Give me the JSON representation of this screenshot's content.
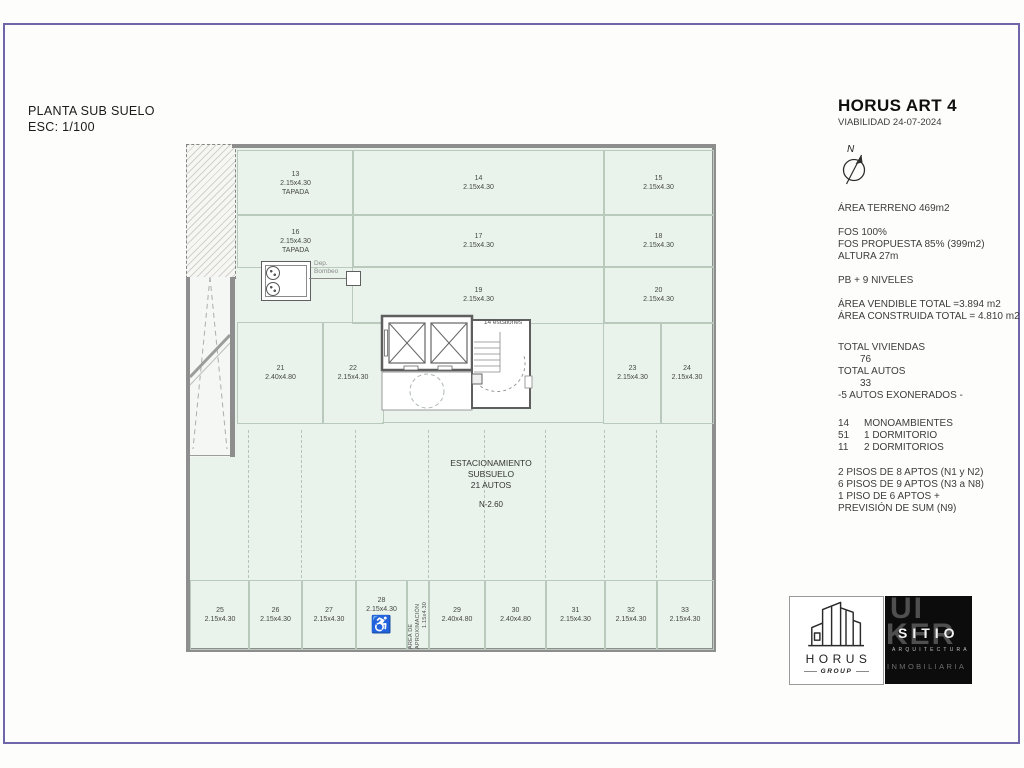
{
  "title_block": {
    "line1": "PLANTA SUB SUELO",
    "line2": "ESC: 1/100"
  },
  "info_panel": {
    "title": "HORUS ART 4",
    "subtitle": "VIABILIDAD 24-07-2024",
    "north_label": "N",
    "area_terreno": "ÁREA TERRENO 469m2",
    "fos": [
      "FOS 100%",
      "FOS PROPUESTA 85% (399m2)",
      "ALTURA 27m"
    ],
    "niveles": "PB + 9 NIVELES",
    "areas": [
      "ÁREA VENDIBLE TOTAL =3.894 m2",
      "ÁREA CONSTRUIDA TOTAL = 4.810 m2"
    ],
    "totals": {
      "l1": "TOTAL VIVIENDAS",
      "v1": "76",
      "l2": "TOTAL AUTOS",
      "v2": "33",
      "l3": "-5 AUTOS EXONERADOS -"
    },
    "units": [
      {
        "n": "14",
        "label": "MONOAMBIENTES"
      },
      {
        "n": "51",
        "label": "1 DORMITORIO"
      },
      {
        "n": "11",
        "label": "2 DORMITORIOS"
      }
    ],
    "pisos": [
      "2 PISOS DE 8 APTOS (N1 y N2)",
      "6 PISOS DE 9 APTOS (N3 a N8)",
      "1 PISO DE 6 APTOS +",
      "PREVISIÓN DE SUM (N9)"
    ]
  },
  "plan": {
    "center_label": [
      "ESTACIONAMIENTO",
      "SUBSUELO",
      "21 AUTOS"
    ],
    "level_label": "N-2.60",
    "stair_label": "14 escalones",
    "pump_label_line1": "Dep.",
    "pump_label_line2": "Bombeo",
    "approach_label": "ÁREA DE APROXIMACIÓN",
    "approach_dims": "1.15x4.30",
    "wheelchair_icon": "♿",
    "spaces": [
      {
        "n": "13",
        "d": "2.15x4.30",
        "tag": "TAPADA",
        "x": 51,
        "y": 6,
        "w": 115,
        "h": 64
      },
      {
        "n": "14",
        "d": "2.15x4.30",
        "x": 166,
        "y": 6,
        "w": 251,
        "h": 64
      },
      {
        "n": "15",
        "d": "2.15x4.30",
        "x": 417,
        "y": 6,
        "w": 109,
        "h": 64
      },
      {
        "n": "16",
        "d": "2.15x4.30",
        "tag": "TAPADA",
        "x": 51,
        "y": 70,
        "w": 115,
        "h": 52
      },
      {
        "n": "17",
        "d": "2.15x4.30",
        "x": 166,
        "y": 70,
        "w": 251,
        "h": 52
      },
      {
        "n": "18",
        "d": "2.15x4.30",
        "x": 417,
        "y": 70,
        "w": 109,
        "h": 52
      },
      {
        "n": "19",
        "d": "2.15x4.30",
        "x": 166,
        "y": 122,
        "w": 251,
        "h": 56
      },
      {
        "n": "20",
        "d": "2.15x4.30",
        "x": 417,
        "y": 122,
        "w": 109,
        "h": 56
      },
      {
        "n": "21",
        "d": "2.40x4.80",
        "x": 51,
        "y": 178,
        "w": 85,
        "h": 100
      },
      {
        "n": "22",
        "d": "2.15x4.30",
        "x": 136,
        "y": 178,
        "w": 60,
        "h": 100
      },
      {
        "n": "23",
        "d": "2.15x4.30",
        "x": 417,
        "y": 178,
        "w": 57,
        "h": 100
      },
      {
        "n": "24",
        "d": "2.15x4.30",
        "x": 474,
        "y": 178,
        "w": 52,
        "h": 100
      },
      {
        "n": "25",
        "d": "2.15x4.30",
        "x": 4,
        "y": 436,
        "w": 58,
        "h": 68
      },
      {
        "n": "26",
        "d": "2.15x4.30",
        "x": 62,
        "y": 436,
        "w": 53,
        "h": 68
      },
      {
        "n": "27",
        "d": "2.15x4.30",
        "x": 115,
        "y": 436,
        "w": 54,
        "h": 68
      },
      {
        "n": "28",
        "d": "2.15x4.30",
        "icon": "wheelchair",
        "x": 169,
        "y": 436,
        "w": 51,
        "h": 68
      },
      {
        "n": "29",
        "d": "2.40x4.80",
        "x": 242,
        "y": 436,
        "w": 56,
        "h": 68
      },
      {
        "n": "30",
        "d": "2.40x4.80",
        "x": 298,
        "y": 436,
        "w": 61,
        "h": 68
      },
      {
        "n": "31",
        "d": "2.15x4.30",
        "x": 359,
        "y": 436,
        "w": 59,
        "h": 68
      },
      {
        "n": "32",
        "d": "2.15x4.30",
        "x": 418,
        "y": 436,
        "w": 52,
        "h": 68
      },
      {
        "n": "33",
        "d": "2.15x4.30",
        "x": 470,
        "y": 436,
        "w": 56,
        "h": 68
      }
    ]
  },
  "logos": {
    "horus": {
      "name": "HORUS",
      "sub": "GROUP"
    },
    "sitio": {
      "big1": "UI",
      "big2": "KER",
      "name": "SITIO",
      "sub": "ARQUITECTURA",
      "bottom": "INMOBILIARIA"
    }
  },
  "colors": {
    "border": "#6f66a9",
    "plan_fill": "#e9f3eb",
    "wall": "#8e8e8e"
  }
}
